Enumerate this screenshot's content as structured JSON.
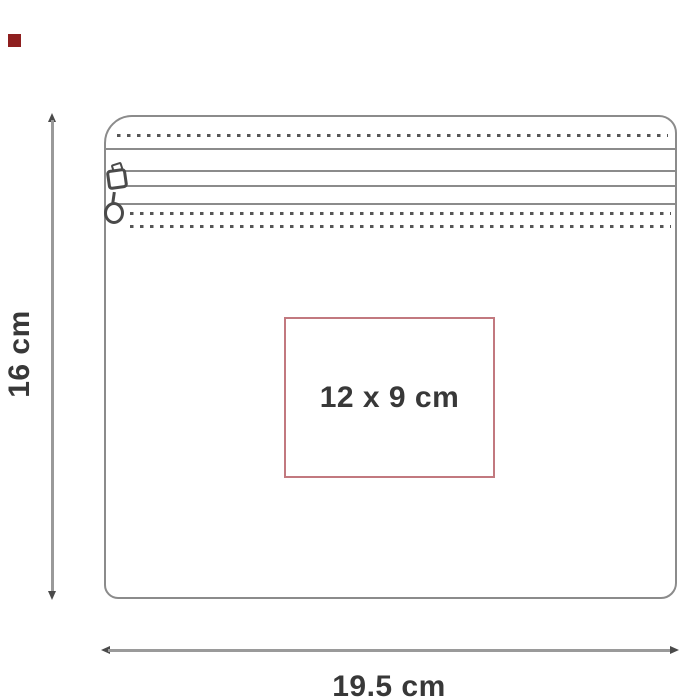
{
  "diagram": {
    "type": "product-dimension-diagram",
    "product": "zippered pouch",
    "print_area": {
      "label": "12 x 9 cm"
    },
    "dimensions": {
      "height_label": "16 cm",
      "width_label": "19.5 cm"
    }
  },
  "colors": {
    "outline": "#8b8b8b",
    "stitch": "#565656",
    "dim_line": "#9a9a9a",
    "arrow": "#4a4a4a",
    "text": "#383838",
    "print_border": "#c2797f",
    "swatch": "#8e1f1f"
  }
}
